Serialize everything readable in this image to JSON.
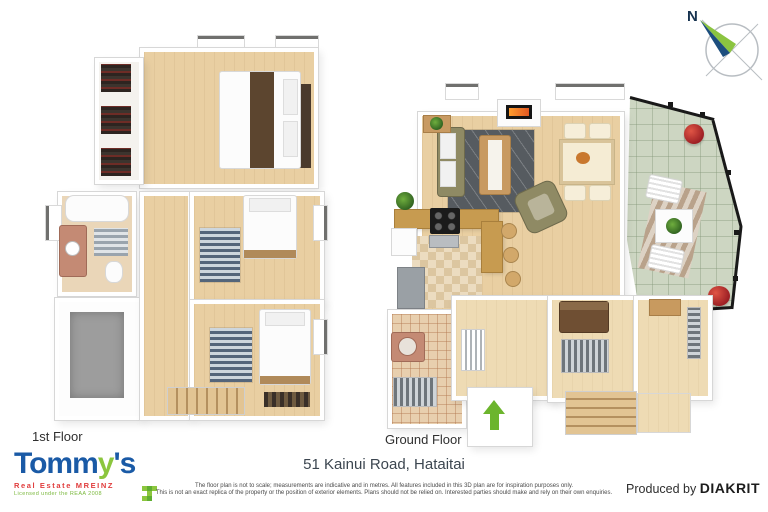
{
  "compass": {
    "north_label": "N"
  },
  "plans": {
    "first": {
      "label": "1st Floor"
    },
    "ground": {
      "label": "Ground Floor"
    }
  },
  "footer": {
    "address": "51 Kainui Road, Hataitai",
    "disclaimer_line1": "The floor plan is not to scale; measurements are indicative and in metres. All features included in this 3D plan are for inspiration purposes only.",
    "disclaimer_line2": "This is not an exact replica of the property or the position of exterior elements. Plans should not be relied on. Interested parties should make and rely on their own enquiries.",
    "produced_by_label": "Produced by",
    "producer_name": "DIAKRIT",
    "logo": {
      "brand_prefix": "Tomm",
      "brand_y": "y",
      "brand_suffix": "'s",
      "tagline": "Real Estate MREINZ",
      "license": "Licensed under the REAA 2008"
    }
  },
  "colors": {
    "brand_blue": "#1a5aa6",
    "brand_green": "#8cc63e",
    "brand_red": "#e03c3c",
    "entry_arrow_green": "#6cb52d",
    "wood_floor": "#e9cfa2",
    "deck_tile": "#cdd6c2",
    "rug_charcoal": "#565b60",
    "sofa_olive": "#8f8a64",
    "compass_needle_green": "#8bc440",
    "compass_needle_navy": "#1d4e7e"
  }
}
